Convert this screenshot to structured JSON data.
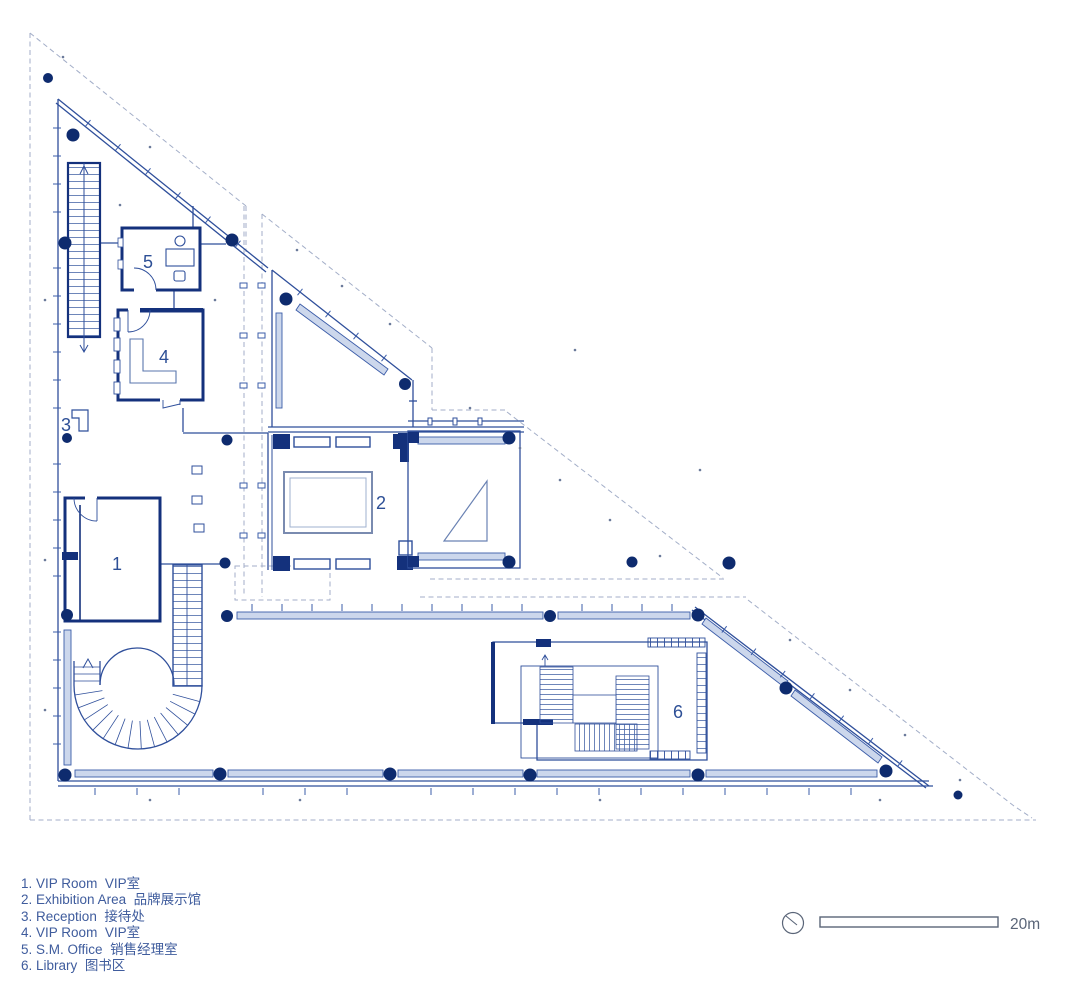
{
  "rooms": [
    {
      "number": "1"
    },
    {
      "number": "2"
    },
    {
      "number": "3"
    },
    {
      "number": "4"
    },
    {
      "number": "5"
    },
    {
      "number": "6"
    }
  ],
  "legend": {
    "items": [
      {
        "num": "1.",
        "en": "VIP Room",
        "zh": "VIP室"
      },
      {
        "num": "2.",
        "en": "Exhibition Area",
        "zh": "品牌展示馆"
      },
      {
        "num": "3.",
        "en": "Reception",
        "zh": "接待处"
      },
      {
        "num": "4.",
        "en": "VIP Room",
        "zh": "VIP室"
      },
      {
        "num": "5.",
        "en": "S.M. Office",
        "zh": "销售经理室"
      },
      {
        "num": "6.",
        "en": "Library",
        "zh": "图书区"
      }
    ]
  },
  "scale_bar": {
    "label": "20m"
  },
  "colors": {
    "wall_navy": "#14317c",
    "line_blue": "#2f4f9b",
    "fill_light": "#ccd7ec",
    "dash_gray": "#a3aec8",
    "column_navy": "#0e2b6e",
    "label_blue": "#2d4f96",
    "legend_text": "#3f5c9d",
    "scale_gray": "#5a6578"
  }
}
